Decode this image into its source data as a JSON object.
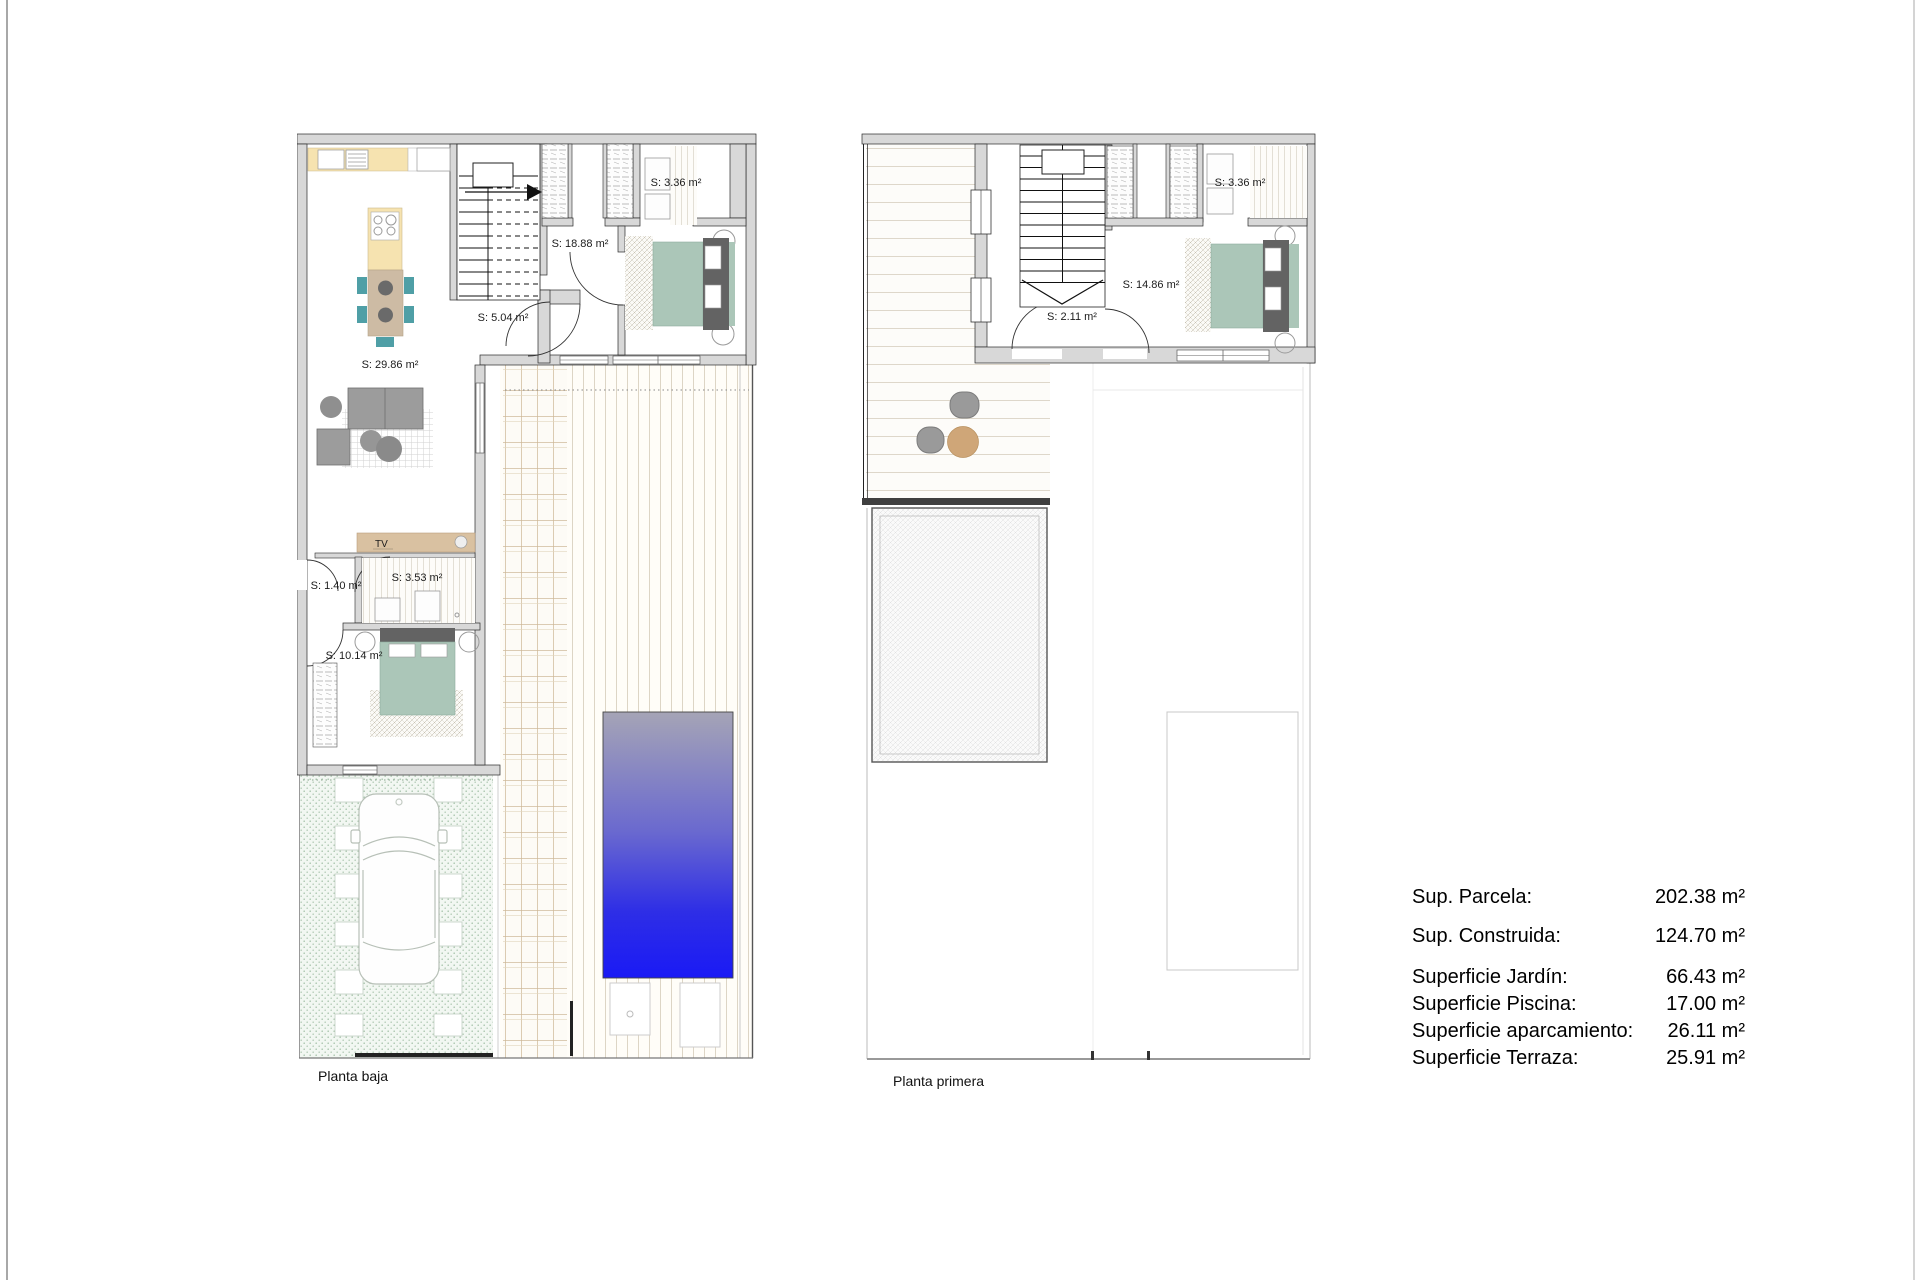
{
  "document": {
    "type": "architectural floor plan sheet",
    "background": "#ffffff"
  },
  "plans": {
    "ground": {
      "caption": "Planta baja",
      "room_labels": {
        "closet": "S: 3.36 m²",
        "hall": "S: 18.88 m²",
        "vestibule": "S: 5.04 m²",
        "living_kitchen": "S: 29.86 m²",
        "corridor": "S: 1.40 m²",
        "bathroom": "S: 3.53 m²",
        "bedroom": "S: 10.14 m²"
      },
      "tv_label": "TV"
    },
    "first": {
      "caption": "Planta primera",
      "room_labels": {
        "closet": "S: 3.36 m²",
        "bedroom": "S: 14.86 m²",
        "landing": "S: 2.11 m²"
      }
    }
  },
  "summary": {
    "rows": [
      {
        "label": "Sup. Parcela:",
        "value": "202.38 m²"
      },
      {
        "label": "Sup. Construida:",
        "value": "124.70 m²"
      },
      {
        "label": "Superficie Jardín:",
        "value": "66.43 m²"
      },
      {
        "label": "Superficie Piscina:",
        "value": "17.00 m²"
      },
      {
        "label": "Superficie aparcamiento:",
        "value": "26.11 m²"
      },
      {
        "label": "Superficie Terraza:",
        "value": "25.91 m²"
      }
    ]
  },
  "colors": {
    "wall_fill": "#d8d8d8",
    "kitchen_counter_cream": "#f6e3b0",
    "table_wood_tan": "#cdbba4",
    "chair_teal": "#4f9fa6",
    "bed_green": "#abc6b8",
    "headboard_gray": "#636363",
    "sofa_gray": "#9c9c9c",
    "tv_unit_tan": "#d9c1a1",
    "terrace_table_tan": "#cfa678",
    "pool_top": "#a5a4b6",
    "pool_bottom": "#1a1af5"
  }
}
